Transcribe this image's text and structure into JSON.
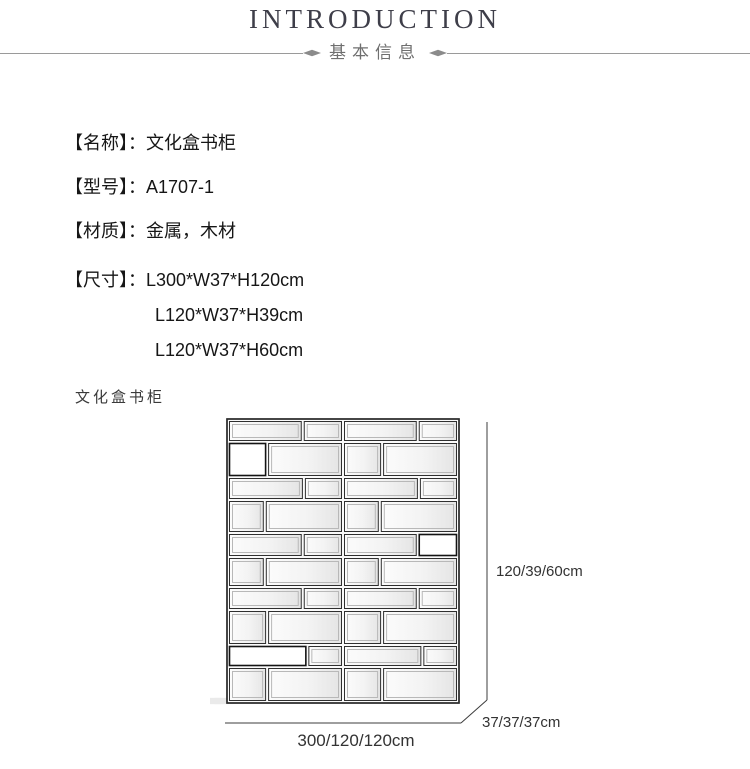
{
  "header": {
    "title": "INTRODUCTION",
    "subtitle": "基本信息"
  },
  "colon": "：",
  "specs": [
    {
      "label": "【名称】",
      "value": "文化盒书柜"
    },
    {
      "label": "【型号】",
      "value": "A1707-1"
    },
    {
      "label": "【材质】",
      "value": "金属，木材"
    },
    {
      "label": "【尺寸】",
      "value": "L300*W37*H120cm",
      "extra": [
        "L120*W37*H39cm",
        "L120*W37*H60cm"
      ]
    }
  ],
  "drawing": {
    "caption": "文化盒书柜",
    "dim_height": "120/39/60cm",
    "dim_depth": "37/37/37cm",
    "dim_width": "300/120/120cm",
    "shelf": {
      "left": 18,
      "top": 15,
      "half_w": 115,
      "rows": [
        {
          "h": 22,
          "f": 0.65
        },
        {
          "h": 35,
          "f": 0.34,
          "white": "L0"
        },
        {
          "h": 23,
          "f": 0.66
        },
        {
          "h": 33,
          "f": 0.32
        },
        {
          "h": 24,
          "f": 0.65,
          "white": "R1"
        },
        {
          "h": 30,
          "f": 0.32
        },
        {
          "h": 23,
          "f": 0.65
        },
        {
          "h": 35,
          "f": 0.34
        },
        {
          "h": 22,
          "f": 0.69,
          "white": "L0"
        },
        {
          "h": 35,
          "f": 0.34
        }
      ]
    }
  },
  "colors": {
    "title": "#3e3e49",
    "subtitle": "#6f6f6f",
    "rule": "#9a9a9a",
    "diamond": "#8b8b8b",
    "body_text": "#161616",
    "drawing_line": "#2f2f2f",
    "dim_text": "#333333"
  }
}
